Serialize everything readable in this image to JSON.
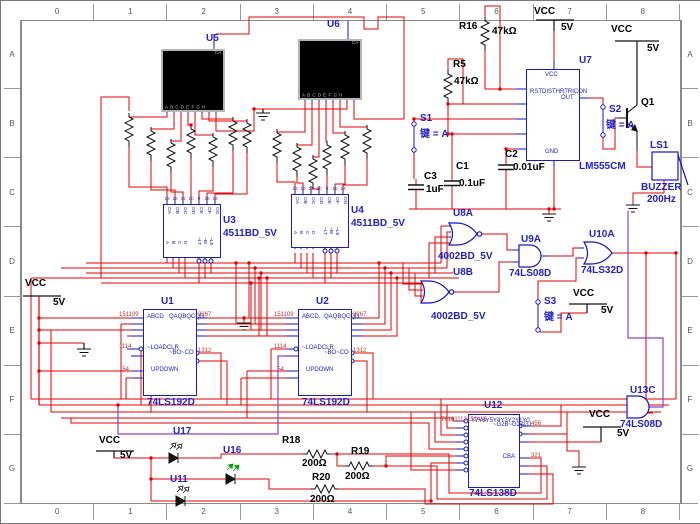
{
  "frame": {
    "columns": [
      "0",
      "1",
      "2",
      "3",
      "4",
      "5",
      "6",
      "7",
      "8"
    ],
    "rows": [
      "A",
      "B",
      "C",
      "D",
      "E",
      "F",
      "G"
    ]
  },
  "power": {
    "vcc": "VCC",
    "v5": "5V"
  },
  "u5": {
    "ref": "U5",
    "corner": "CA",
    "pins": [
      "A",
      "B",
      "C",
      "D",
      "E",
      "F",
      "G",
      "H"
    ]
  },
  "u6": {
    "ref": "U6",
    "corner": "CA",
    "pins": [
      "A",
      "B",
      "C",
      "D",
      "E",
      "F",
      "G",
      "H"
    ]
  },
  "u3": {
    "ref": "U3",
    "part": "4511BD_5V",
    "top_nums": [
      "13",
      "12",
      "11",
      "10",
      "9",
      "15",
      "14"
    ],
    "top_pins": [
      "OA",
      "OB",
      "OC",
      "OD",
      "OE",
      "OF",
      "OG"
    ],
    "in_pins": [
      "A",
      "B",
      "C",
      "D"
    ],
    "ctl_pins": [
      "~LT",
      "~BI",
      "~LE"
    ]
  },
  "u4": {
    "ref": "U4",
    "part": "4511BD_5V",
    "top_nums": [
      "13",
      "12",
      "11",
      "10",
      "9",
      "15",
      "14"
    ],
    "top_pins": [
      "OA",
      "OB",
      "OC",
      "OD",
      "OE",
      "OF",
      "OG"
    ],
    "in_pins": [
      "A",
      "B",
      "C",
      "D"
    ],
    "ctl_pins": [
      "~LT",
      "~BI",
      "~LE"
    ]
  },
  "u1": {
    "ref": "U1",
    "part": "74LS192D",
    "in_labels": [
      "A",
      "B",
      "C",
      "D"
    ],
    "in_nums": [
      "15",
      "1",
      "10",
      "9"
    ],
    "ctl_labels": [
      "~LOAD",
      "CLR"
    ],
    "ctl_nums": [
      "11",
      "14"
    ],
    "clk_labels": [
      "UP",
      "DOWN"
    ],
    "clk_nums": [
      "5",
      "4"
    ],
    "q_labels": [
      "QA",
      "QB",
      "QC",
      "QD"
    ],
    "q_nums": [
      "3",
      "2",
      "6",
      "7"
    ],
    "carry_labels": [
      "~BO",
      "~CO"
    ],
    "carry_nums": [
      "13",
      "12"
    ]
  },
  "u2": {
    "ref": "U2",
    "part": "74LS192D",
    "in_labels": [
      "A",
      "B",
      "C",
      "D"
    ],
    "in_nums": [
      "15",
      "1",
      "10",
      "9"
    ],
    "ctl_labels": [
      "~LOAD",
      "CLR"
    ],
    "ctl_nums": [
      "11",
      "14"
    ],
    "clk_labels": [
      "UP",
      "DOWN"
    ],
    "clk_nums": [
      "5",
      "4"
    ],
    "q_labels": [
      "QA",
      "QB",
      "QC",
      "QD"
    ],
    "q_nums": [
      "3",
      "2",
      "6",
      "7"
    ],
    "carry_labels": [
      "~BO",
      "~CO"
    ],
    "carry_nums": [
      "13",
      "12"
    ]
  },
  "u7": {
    "ref": "U7",
    "part": "LM555CM",
    "top_pin": "VCC",
    "bottom_pin": "GND",
    "left_pins": [
      "RST",
      "DIS",
      "THR",
      "TRI",
      "CON"
    ],
    "right_pin": "OUT"
  },
  "u8a": {
    "ref": "U8A",
    "part": "4002BD_5V"
  },
  "u8b": {
    "ref": "U8B",
    "part": "4002BD_5V"
  },
  "u9a": {
    "ref": "U9A",
    "part": "74LS08D"
  },
  "u10a": {
    "ref": "U10A",
    "part": "74LS32D"
  },
  "u13c": {
    "ref": "U13C",
    "part": "74LS08D"
  },
  "u12": {
    "ref": "U12",
    "part": "74LS138D",
    "y_labels": [
      "Y7",
      "Y6",
      "Y5",
      "Y4",
      "Y3",
      "Y2",
      "Y1",
      "Y0"
    ],
    "y_nums": [
      "7",
      "9",
      "10",
      "11",
      "12",
      "13",
      "14",
      "15"
    ],
    "en_labels": [
      "~G2B",
      "~G2A",
      "G1"
    ],
    "en_nums": [
      "4",
      "5",
      "6"
    ],
    "sel_labels": [
      "C",
      "B",
      "A"
    ],
    "sel_nums": [
      "3",
      "2",
      "1"
    ]
  },
  "r16": {
    "ref": "R16",
    "value": "47kΩ"
  },
  "r5": {
    "ref": "R5",
    "value": "47kΩ"
  },
  "r18": {
    "ref": "R18",
    "value": "200Ω"
  },
  "r19": {
    "ref": "R19",
    "value": "200Ω"
  },
  "r20": {
    "ref": "R20",
    "value": "200Ω"
  },
  "c1": {
    "ref": "C1",
    "value": "0.1uF"
  },
  "c2": {
    "ref": "C2",
    "value": "0.01uF"
  },
  "c3": {
    "ref": "C3",
    "value": "1uF"
  },
  "s1": {
    "ref": "S1",
    "key": "键 = A"
  },
  "s2": {
    "ref": "S2",
    "key": "键 = A"
  },
  "s3": {
    "ref": "S3",
    "key": "键 = A"
  },
  "q1": {
    "ref": "Q1"
  },
  "ls1": {
    "ref": "LS1",
    "type": "BUZZER",
    "freq": "200Hz"
  },
  "u17": {
    "ref": "U17"
  },
  "u16": {
    "ref": "U16"
  },
  "u11": {
    "ref": "U11"
  },
  "colors": {
    "wire_red": "#e60000",
    "wire_blue": "#1515cc",
    "wire_purple": "#8844d4",
    "label_blue": "#2222cc",
    "pin_number_red": "#c03030",
    "display_black": "#000000"
  }
}
